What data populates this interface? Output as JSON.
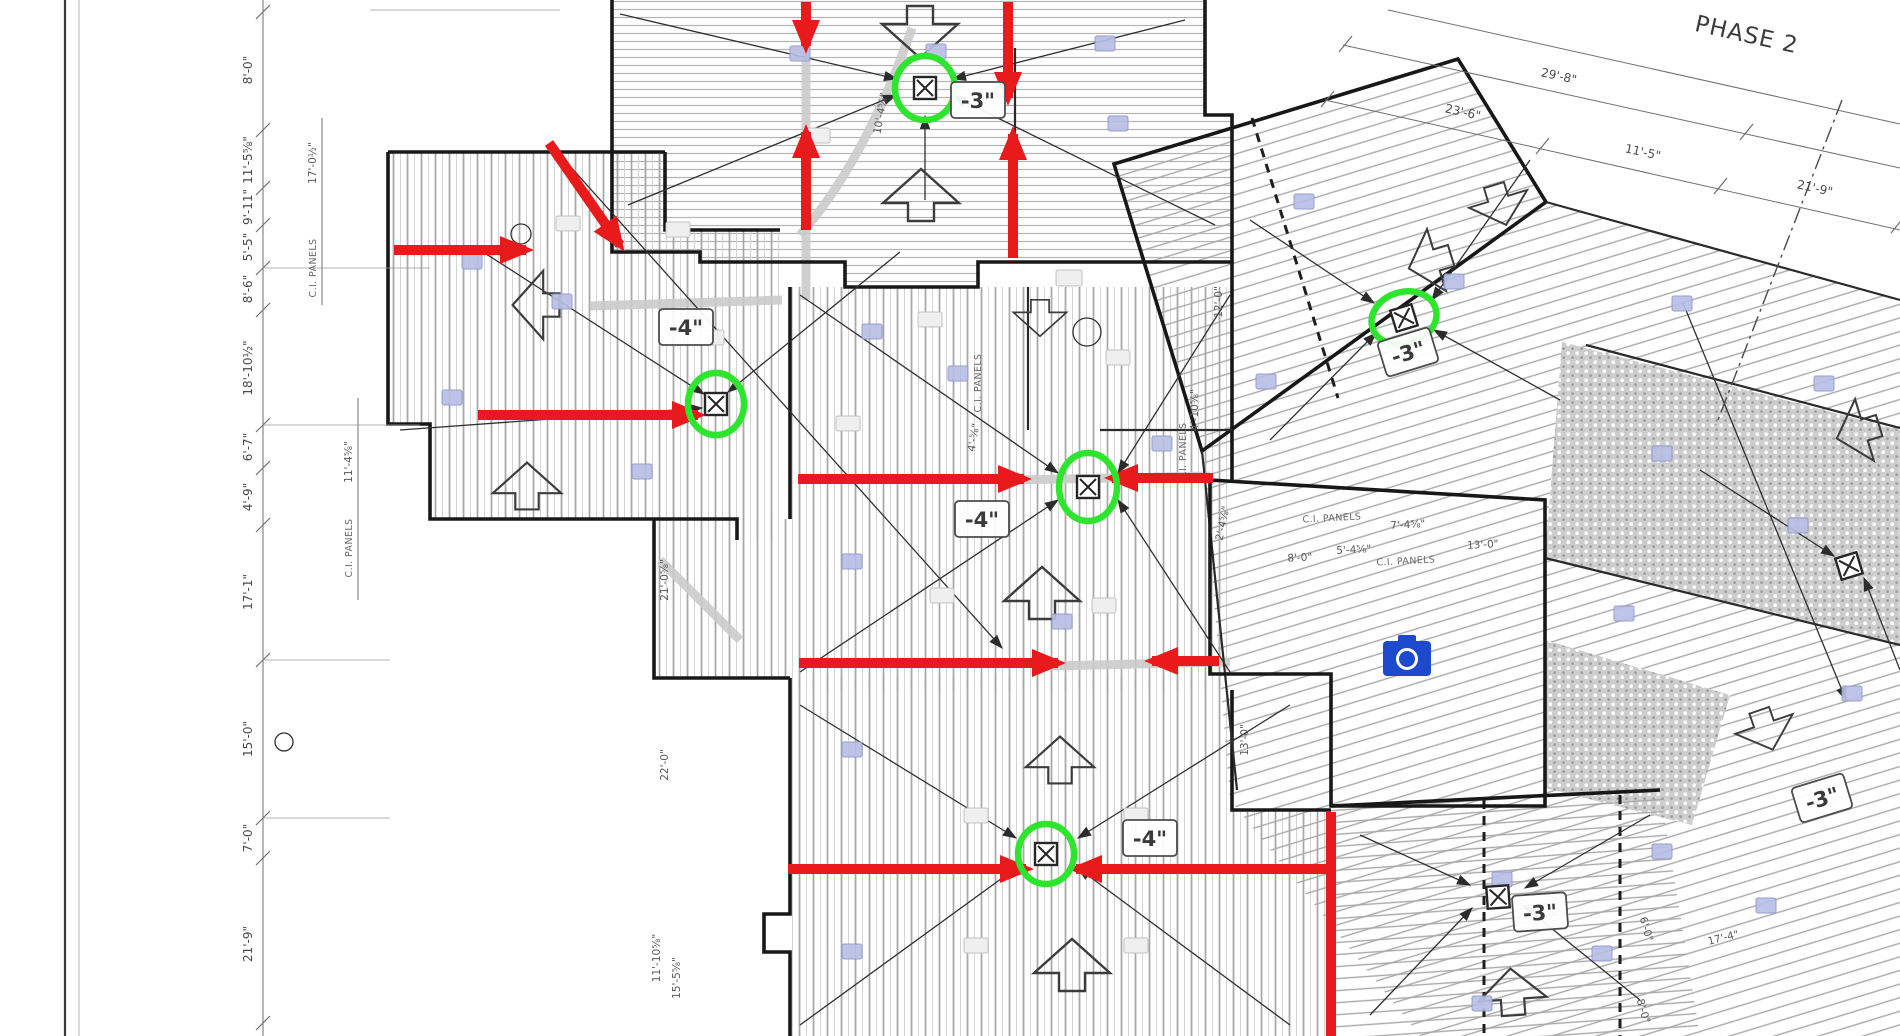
{
  "drawing": {
    "phase_label": "PHASE 2",
    "panels_label": "C.I. PANELS"
  },
  "drain_labels": [
    "-3\"",
    "-4\"",
    "-4\"",
    "-3\"",
    "-4\"",
    "-3\"",
    "-3\""
  ],
  "dimensions": {
    "left": [
      "8'-0\"",
      "11'-5⅝\"",
      "9'-11\"",
      "5'-5\"",
      "8'-6\"",
      "18'-10½\"",
      "6'-7\"",
      "4'-9\"",
      "17'-1\"",
      "15'-0\"",
      "7'-0\"",
      "21'-9\""
    ],
    "left_inner": [
      "17'-0½\"",
      "11'-4⅝\""
    ],
    "top_right": [
      "29'-8\"",
      "23'-6\"",
      "11'-5\"",
      "21'-9\""
    ],
    "interior": [
      "12'-0\"",
      "4'-10⅝\"",
      "13'-0\"",
      "7'-4⅝\"",
      "5'-4⅝\"",
      "8'-0\"",
      "2'-4⅝\"",
      "21'-0⅝\"",
      "22'-0\"",
      "11'-10⅝\"",
      "15'-5⅝\"",
      "10'-4⅝\"",
      "4'-⅝\"",
      "17'-4\"",
      "6'-0\""
    ]
  },
  "colors": {
    "markup_red": "#e81a1c",
    "markup_green": "#2ee52e",
    "camera_blue": "#1d49cf"
  },
  "icons": {
    "camera": "photo-marker",
    "drain": "roof-drain",
    "slope_arrow": "slope-direction-arrow"
  }
}
